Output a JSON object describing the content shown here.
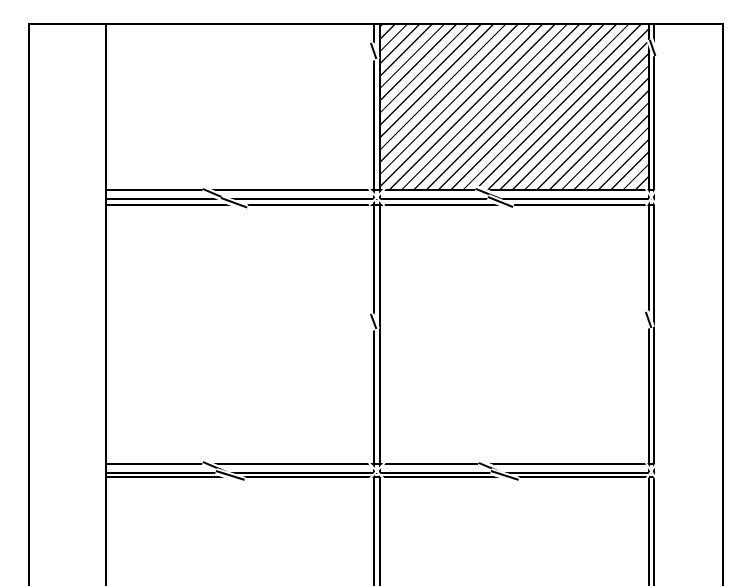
{
  "drawing": {
    "description": "Monochrome CAD elevation drawing of a paneled door/partition, cropped at the bottom. Two columns by three visible rows of rectangular panels inside an outer frame; the top-right panel is filled with 45-degree forward-slash hatching. Break (jog) marks appear on the horizontal rails and on the vertical mullion and right stile lines.",
    "background_color": "#ffffff",
    "line_color": "#000000",
    "canvas": {
      "width": 750,
      "height": 586
    },
    "grid": {
      "columns": 2,
      "visible_rows": 3,
      "hatched_panel": "top-right"
    },
    "vertical_lines": [
      {
        "name": "outer-left-line",
        "x": 28,
        "y": 23,
        "w": 1.8,
        "h": 563
      },
      {
        "name": "left-stile-line",
        "x": 104.5,
        "y": 23,
        "w": 2.6,
        "h": 563
      },
      {
        "name": "mullion-left-line",
        "x": 373.2,
        "y": 23,
        "w": 2.0,
        "h": 563
      },
      {
        "name": "mullion-right-line",
        "x": 379.0,
        "y": 23,
        "w": 2.0,
        "h": 563
      },
      {
        "name": "right-stile-inner-line",
        "x": 648.3,
        "y": 23,
        "w": 2.0,
        "h": 563
      },
      {
        "name": "right-stile-outer-line",
        "x": 653.0,
        "y": 23,
        "w": 1.8,
        "h": 563
      },
      {
        "name": "outer-right-line",
        "x": 722.0,
        "y": 23,
        "w": 1.8,
        "h": 563
      }
    ],
    "horizontal_lines": [
      {
        "name": "frame-top-line",
        "x": 28,
        "y": 23.0,
        "w": 695.8,
        "h": 2.2
      },
      {
        "name": "rail1-top-line",
        "x": 104.5,
        "y": 189.0,
        "w": 550.3,
        "h": 2.0
      },
      {
        "name": "rail1-mid-line",
        "x": 104.5,
        "y": 197.5,
        "w": 550.3,
        "h": 2.0
      },
      {
        "name": "rail1-bottom-line",
        "x": 104.5,
        "y": 203.5,
        "w": 550.3,
        "h": 2.0
      },
      {
        "name": "rail2-top-line",
        "x": 104.5,
        "y": 463.0,
        "w": 550.3,
        "h": 2.0
      },
      {
        "name": "rail2-mid-line",
        "x": 104.5,
        "y": 471.5,
        "w": 550.3,
        "h": 2.0
      },
      {
        "name": "rail2-bottom-line",
        "x": 104.5,
        "y": 476.0,
        "w": 550.3,
        "h": 2.0
      }
    ],
    "hatch_panel": {
      "name": "hatched-panel",
      "x": 381.0,
      "y": 25.2,
      "width": 267.3,
      "height": 163.8,
      "pattern": "diagonal-forward-slash",
      "angle_deg": 45,
      "perpendicular_period_px": 8.7,
      "stroke_px": 1.3
    },
    "break_marks": [
      {
        "name": "break-mullion-top",
        "halo": 7.0,
        "stroke": 1.7,
        "strokes": [
          {
            "x1": 371.0,
            "y1": 43.0,
            "x2": 376.5,
            "y2": 59.0
          }
        ]
      },
      {
        "name": "break-right-stile-top",
        "halo": 7.0,
        "stroke": 1.7,
        "strokes": [
          {
            "x1": 649.5,
            "y1": 39.5,
            "x2": 655.0,
            "y2": 55.5
          }
        ]
      },
      {
        "name": "break-mullion-middle",
        "halo": 7.0,
        "stroke": 1.7,
        "strokes": [
          {
            "x1": 370.5,
            "y1": 314.0,
            "x2": 376.0,
            "y2": 329.0
          }
        ]
      },
      {
        "name": "break-right-stile-middle",
        "halo": 7.0,
        "stroke": 1.7,
        "strokes": [
          {
            "x1": 646.0,
            "y1": 311.5,
            "x2": 651.5,
            "y2": 327.5
          }
        ]
      },
      {
        "name": "break-rail1-left",
        "halo": 6.5,
        "stroke": 1.7,
        "strokes": [
          {
            "x1": 203.0,
            "y1": 189.0,
            "x2": 229.0,
            "y2": 200.0
          },
          {
            "x1": 221.0,
            "y1": 198.0,
            "x2": 247.0,
            "y2": 207.5
          }
        ]
      },
      {
        "name": "break-rail1-right",
        "halo": 6.5,
        "stroke": 1.7,
        "strokes": [
          {
            "x1": 476.0,
            "y1": 188.5,
            "x2": 502.0,
            "y2": 199.0
          },
          {
            "x1": 488.0,
            "y1": 197.0,
            "x2": 513.0,
            "y2": 207.0
          }
        ]
      },
      {
        "name": "break-rail2-left",
        "halo": 6.5,
        "stroke": 1.7,
        "strokes": [
          {
            "x1": 203.0,
            "y1": 462.0,
            "x2": 229.0,
            "y2": 473.0
          },
          {
            "x1": 216.0,
            "y1": 471.0,
            "x2": 245.0,
            "y2": 480.0
          }
        ]
      },
      {
        "name": "break-rail2-right",
        "halo": 6.5,
        "stroke": 1.7,
        "strokes": [
          {
            "x1": 479.0,
            "y1": 462.5,
            "x2": 504.0,
            "y2": 473.0
          },
          {
            "x1": 491.0,
            "y1": 471.0,
            "x2": 519.0,
            "y2": 480.0
          }
        ]
      }
    ],
    "crossing_notches": [
      {
        "name": "notch-mullion-rail1",
        "halo": 1.7,
        "strokes": [
          {
            "x1": 368.5,
            "y1": 189.0,
            "x2": 384.5,
            "y2": 206.0
          },
          {
            "x1": 384.5,
            "y1": 189.0,
            "x2": 368.5,
            "y2": 206.0
          }
        ]
      },
      {
        "name": "notch-mullion-rail2",
        "halo": 1.7,
        "strokes": [
          {
            "x1": 368.5,
            "y1": 462.5,
            "x2": 384.5,
            "y2": 479.5
          },
          {
            "x1": 384.5,
            "y1": 462.5,
            "x2": 368.5,
            "y2": 479.5
          }
        ]
      },
      {
        "name": "notch-right-stile-rail1",
        "halo": 1.7,
        "strokes": [
          {
            "x1": 646.0,
            "y1": 189.0,
            "x2": 657.0,
            "y2": 206.0
          },
          {
            "x1": 657.0,
            "y1": 189.0,
            "x2": 646.0,
            "y2": 206.0
          }
        ]
      },
      {
        "name": "notch-right-stile-rail2",
        "halo": 1.7,
        "strokes": [
          {
            "x1": 646.0,
            "y1": 462.5,
            "x2": 657.0,
            "y2": 479.5
          },
          {
            "x1": 657.0,
            "y1": 462.5,
            "x2": 646.0,
            "y2": 479.5
          }
        ]
      }
    ]
  }
}
